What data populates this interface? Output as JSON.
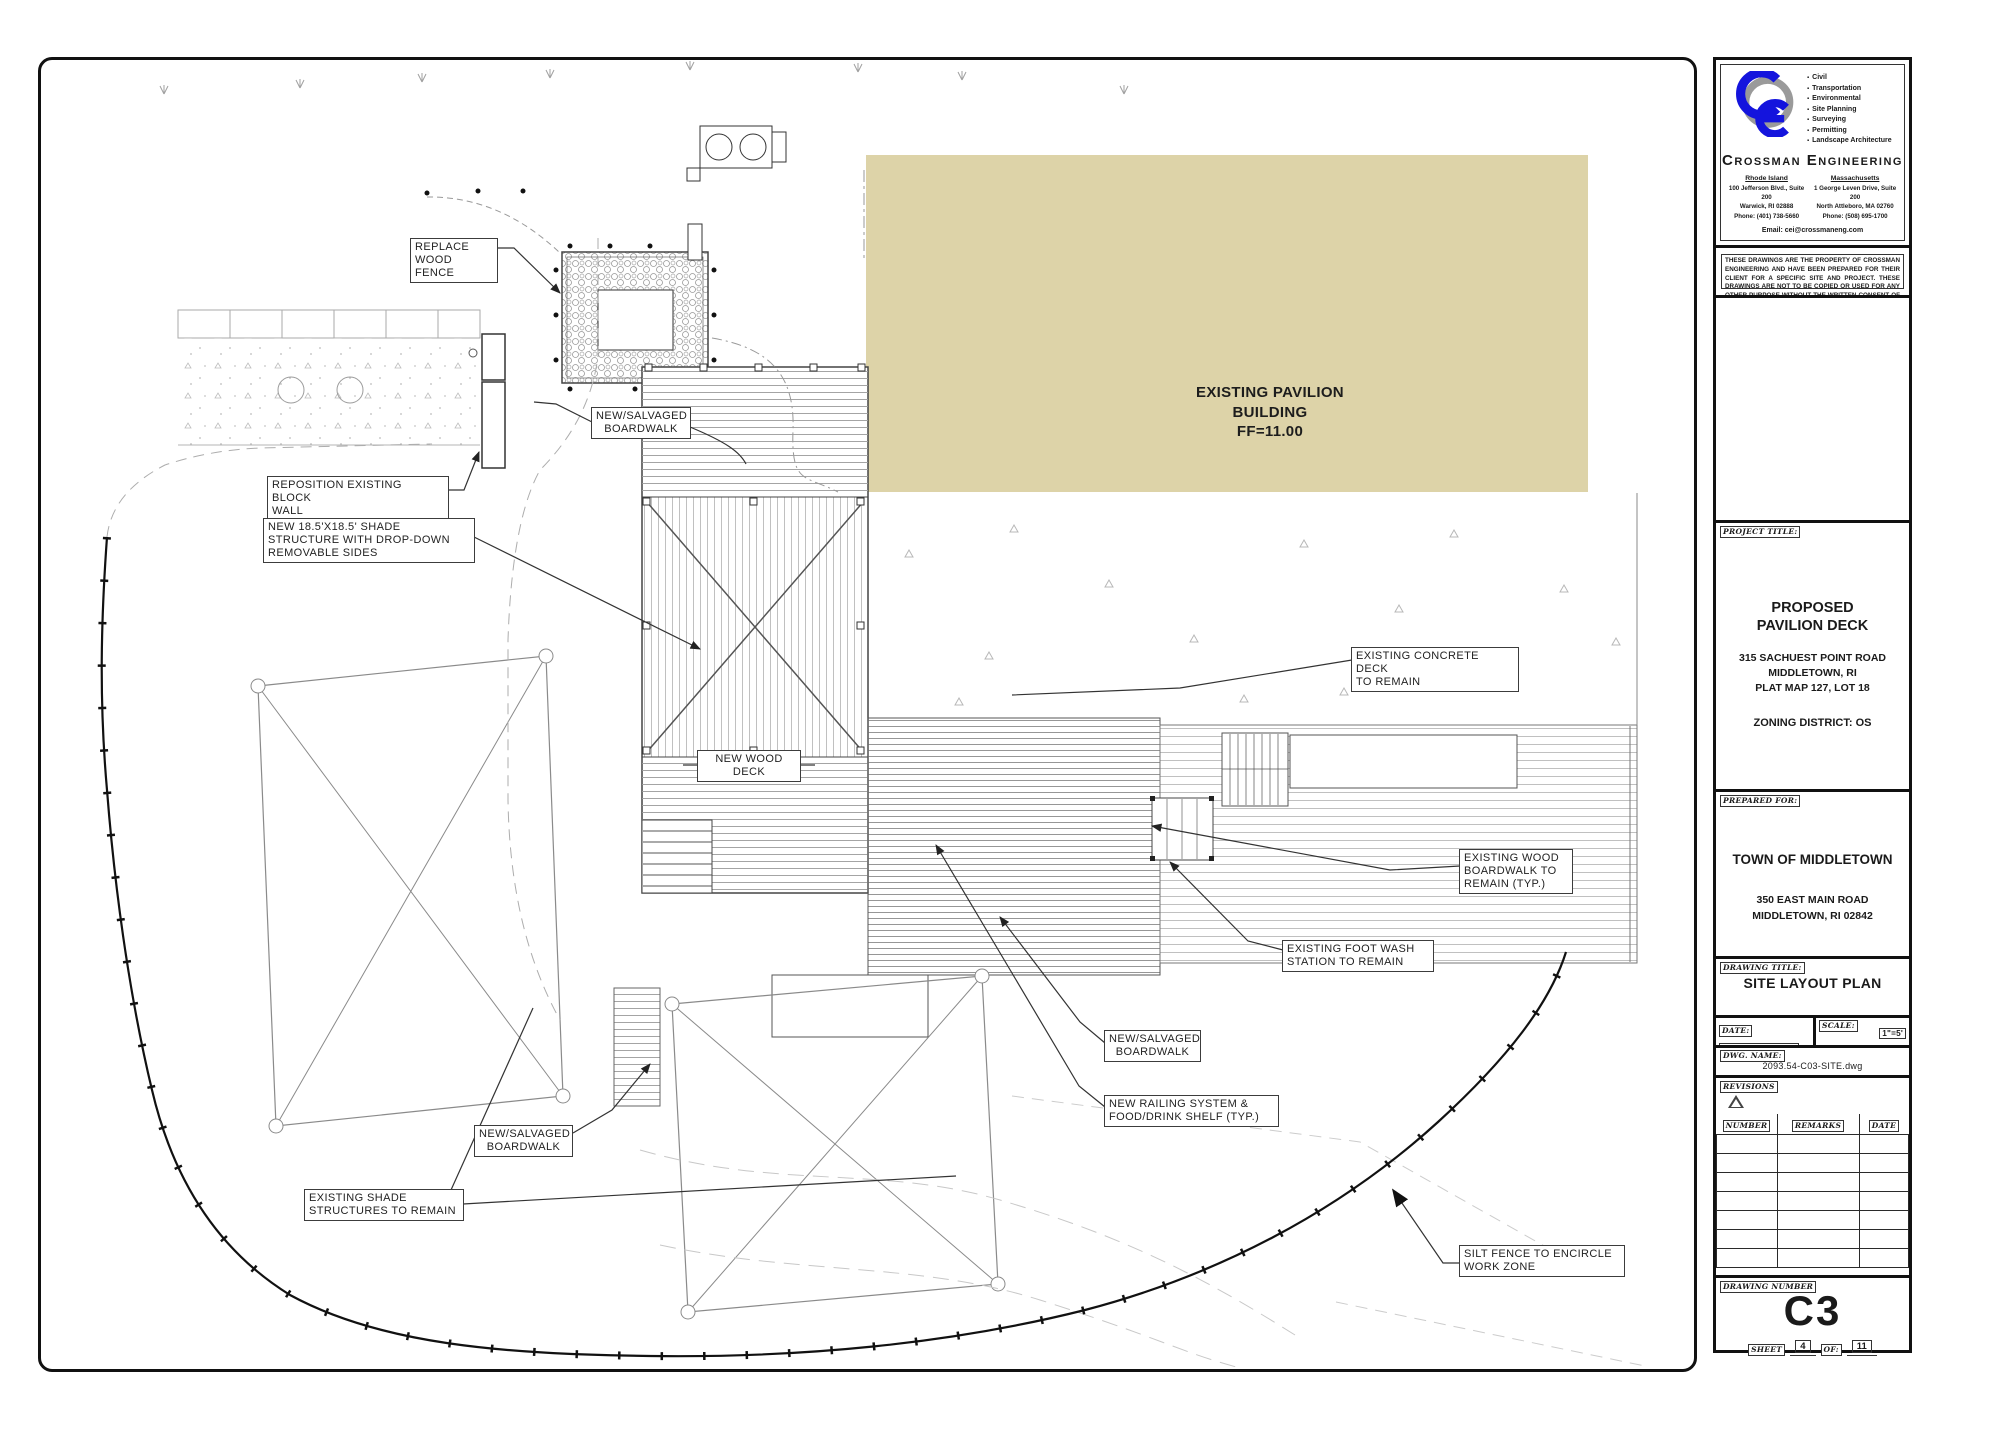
{
  "plan": {
    "labels": {
      "replace_wood_fence": "REPLACE\nWOOD FENCE",
      "reposition_block_wall": "REPOSITION EXISTING BLOCK\nWALL",
      "new_shade_structure": "NEW 18.5'X18.5' SHADE\nSTRUCTURE WITH DROP-DOWN\nREMOVABLE SIDES",
      "new_salvaged_boardwalk_top": "NEW/SALVAGED\nBOARDWALK",
      "new_wood_deck": "NEW WOOD\nDECK",
      "existing_concrete_deck": "EXISTING CONCRETE DECK\nTO REMAIN",
      "existing_wood_boardwalk": "EXISTING WOOD\nBOARDWALK TO\nREMAIN (TYP.)",
      "existing_foot_wash": "EXISTING FOOT WASH\nSTATION TO REMAIN",
      "new_salvaged_boardwalk_right": "NEW/SALVAGED\nBOARDWALK",
      "new_railing_system": "NEW RAILING SYSTEM &\nFOOD/DRINK SHELF (TYP.)",
      "new_salvaged_boardwalk_left": "NEW/SALVAGED\nBOARDWALK",
      "existing_shade_structures": "EXISTING SHADE\nSTRUCTURES TO REMAIN",
      "silt_fence": "SILT FENCE TO ENCIRCLE\nWORK ZONE",
      "pavilion": "EXISTING PAVILION\nBUILDING\nFF=11.00"
    },
    "colors": {
      "pavilion_fill": "#ddd3a8"
    }
  },
  "title_block": {
    "company": {
      "name": "Crossman Engineering",
      "services": [
        "Civil",
        "Transportation",
        "Environmental",
        "Site Planning",
        "Surveying",
        "Permitting",
        "Landscape Architecture"
      ],
      "office_ri": {
        "region": "Rhode Island",
        "line1": "100 Jefferson Blvd., Suite 200",
        "line2": "Warwick, RI 02888",
        "line3": "Phone: (401) 738-5660"
      },
      "office_ma": {
        "region": "Massachusetts",
        "line1": "1 George Leven Drive, Suite 200",
        "line2": "North Attleboro, MA 02760",
        "line3": "Phone: (508) 695-1700"
      },
      "email": "Email: cei@crossmaneng.com",
      "disclaimer": "THESE DRAWINGS ARE THE PROPERTY OF CROSSMAN ENGINEERING AND HAVE BEEN PREPARED FOR THEIR CLIENT FOR A SPECIFIC SITE AND PROJECT. THESE DRAWINGS ARE NOT TO BE COPIED OR USED FOR ANY OTHER PURPOSE WITHOUT THE WRITTEN CONSENT OF CROSSMAN ENGINEERING."
    },
    "project": {
      "label": "PROJECT TITLE:",
      "name": "PROPOSED\nPAVILION DECK",
      "address": "315 SACHUEST POINT ROAD\nMIDDLETOWN, RI\nPLAT MAP 127, LOT 18",
      "zoning": "ZONING DISTRICT: OS"
    },
    "prepared_for": {
      "label": "PREPARED FOR:",
      "client": "TOWN OF MIDDLETOWN",
      "address": "350 EAST MAIN ROAD\nMIDDLETOWN, RI 02842"
    },
    "drawing": {
      "title_label": "DRAWING TITLE:",
      "title": "SITE LAYOUT PLAN",
      "date_label": "DATE:",
      "date": "SEPTEMBER 2025",
      "scale_label": "SCALE:",
      "scale": "1\"=5'",
      "dwg_label": "DWG. NAME:",
      "dwg_name": "2093.54-C03-SITE.dwg"
    },
    "revisions": {
      "label": "REVISIONS",
      "col_number": "NUMBER",
      "col_remarks": "REMARKS",
      "col_date": "DATE"
    },
    "number": {
      "label": "DRAWING NUMBER",
      "value": "C3",
      "sheet_label": "SHEET",
      "sheet": "4",
      "of_label": "OF:",
      "total": "11"
    }
  }
}
